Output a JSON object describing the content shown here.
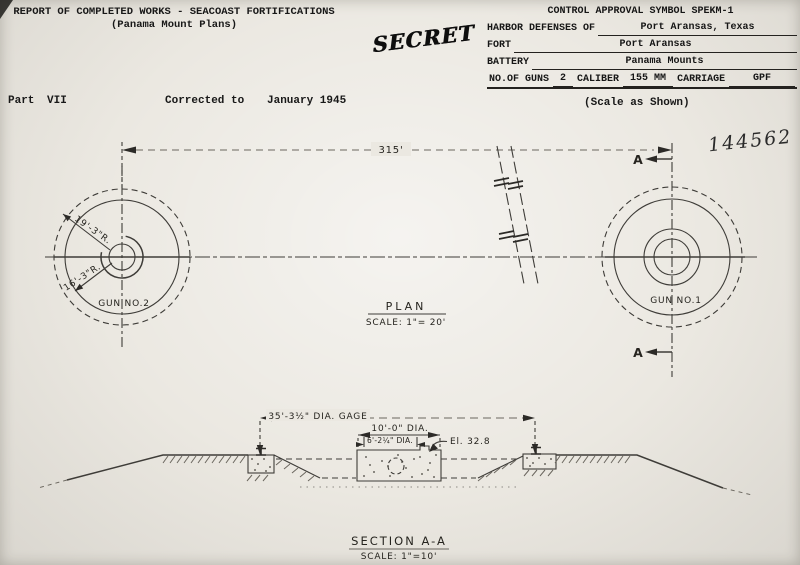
{
  "header": {
    "title_line1": "REPORT OF COMPLETED WORKS - SEACOAST FORTIFICATIONS",
    "title_line2": "(Panama Mount Plans)",
    "stamp": "SECRET"
  },
  "control_table": {
    "control_row": "CONTROL APPROVAL SYMBOL SPEKM-1",
    "rows": [
      {
        "label": "HARBOR DEFENSES OF",
        "value": "Port Aransas, Texas"
      },
      {
        "label": "FORT",
        "value": "Port Aransas"
      },
      {
        "label": "BATTERY",
        "value": "Panama Mounts"
      }
    ],
    "guns_row": {
      "label_guns": "NO.OF GUNS",
      "value_guns": "2",
      "label_caliber": "CALIBER",
      "value_caliber": "155 MM",
      "label_carriage": "CARRIAGE",
      "value_carriage": "GPF"
    }
  },
  "subheader": {
    "part_label": "Part",
    "part_value": "VII",
    "corrected_label": "Corrected to",
    "corrected_value": "January 1945",
    "scale_note": "(Scale as Shown)",
    "serial_number": "144562"
  },
  "plan": {
    "title": "PLAN",
    "scale": "SCALE: 1\"= 20'",
    "span": "315'",
    "gun1": "GUN NO.1",
    "gun2": "GUN NO.2",
    "radius_outer": "19'-3\"R.",
    "radius_inner": "16'-3\"R.",
    "marker_top": "A",
    "marker_bottom": "A"
  },
  "section": {
    "title": "SECTION A-A",
    "scale": "SCALE: 1\"=10'",
    "dim_gage": "35'-3½\" DIA. GAGE",
    "dim_base": "10'-0\" DIA.",
    "dim_pintle": "6'-2¼\" DIA.",
    "elevation": "El. 32.8"
  }
}
